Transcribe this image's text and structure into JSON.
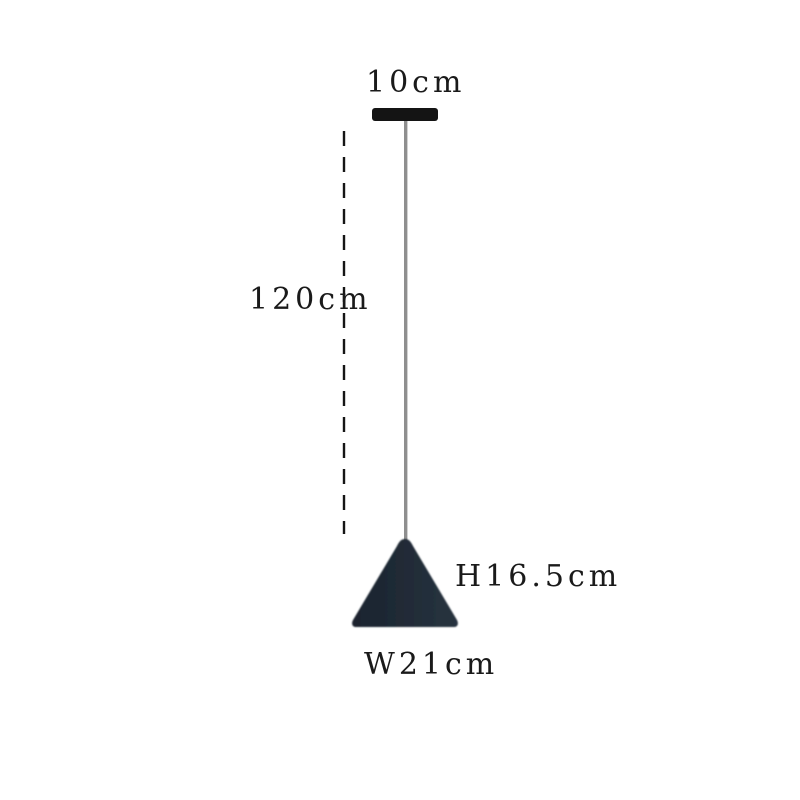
{
  "diagram": {
    "title_hint": "pendant-lamp-dimension-diagram",
    "labels": {
      "mount_width": "10cm",
      "cord_length": "120cm",
      "shade_height": "H16.5cm",
      "shade_width": "W21cm"
    },
    "colors": {
      "background": "#ffffff",
      "text": "#1a1a1a",
      "ceiling_mount": "#141414",
      "cord": "#8f8f8f",
      "dash_line": "#151515",
      "shade_dark": "#1a232e",
      "shade_light": "#27333f"
    }
  }
}
